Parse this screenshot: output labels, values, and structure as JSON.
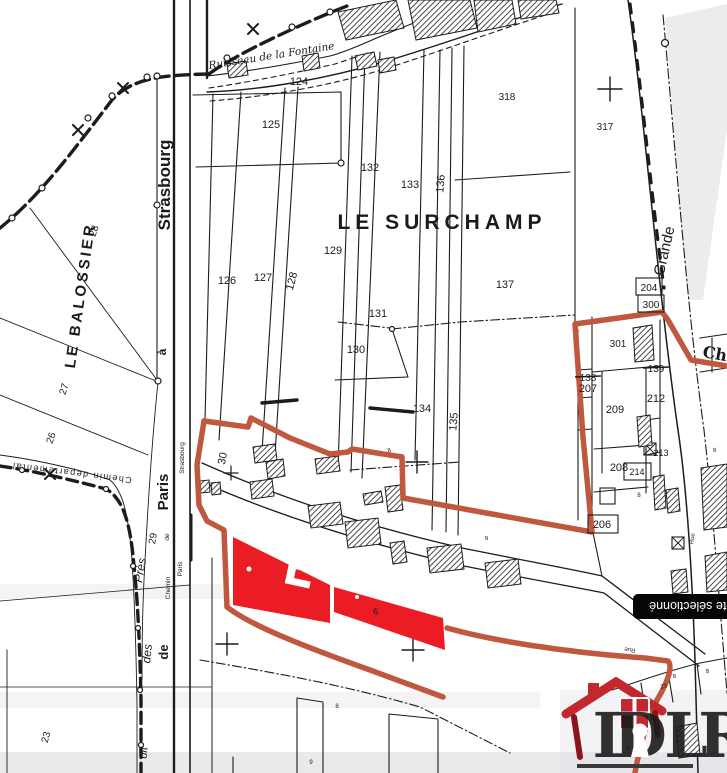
{
  "map": {
    "area_labels": [
      {
        "t": "LE SURCHAMP",
        "x": 442,
        "y": 229,
        "fs": 21,
        "b": 1,
        "ls": 5,
        "name": "area-label-le-surchamp"
      },
      {
        "t": "LE BALOSSIER",
        "x": 85,
        "y": 296,
        "r": -82,
        "fs": 15,
        "b": 1,
        "ls": 3,
        "name": "area-label-le-balossier"
      }
    ],
    "street_labels": [
      {
        "t": "Strasbourg",
        "x": 170,
        "y": 185,
        "r": -90,
        "fs": 17,
        "b": 1
      },
      {
        "t": "à",
        "x": 166,
        "y": 352,
        "r": -90,
        "fs": 12,
        "b": 1
      },
      {
        "t": "Paris",
        "x": 168,
        "y": 492,
        "r": -90,
        "fs": 15,
        "b": 1
      },
      {
        "t": "de",
        "x": 168,
        "y": 652,
        "r": -90,
        "fs": 13,
        "b": 1
      },
      {
        "t": "Grande",
        "x": 669,
        "y": 252,
        "r": -77,
        "fs": 15
      },
      {
        "t": "Ch",
        "x": 714,
        "y": 359,
        "r": 10,
        "fs": 16,
        "b": 1,
        "serif": 1
      },
      {
        "t": "Rue",
        "x": 694,
        "y": 539,
        "r": -80,
        "fs": 6
      },
      {
        "t": "Rue",
        "x": 630,
        "y": 648,
        "r": 186,
        "fs": 6
      },
      {
        "t": "Strasbourg",
        "x": 184,
        "y": 458,
        "r": -90,
        "fs": 6.5
      },
      {
        "t": "Paris",
        "x": 182,
        "y": 569,
        "r": -90,
        "fs": 6.5
      },
      {
        "t": "Chemin",
        "x": 170,
        "y": 588,
        "r": -90,
        "fs": 6.5
      },
      {
        "t": "de",
        "x": 169,
        "y": 537,
        "r": -90,
        "fs": 6.5
      },
      {
        "t": "Chemin departemental",
        "x": 72,
        "y": 470,
        "r": 187,
        "fs": 9,
        "ls": 1.5
      },
      {
        "t": "dit",
        "x": 147,
        "y": 753,
        "r": -85,
        "fs": 11,
        "i": 1
      },
      {
        "t": "des",
        "x": 151,
        "y": 654,
        "r": -85,
        "fs": 12,
        "i": 1
      },
      {
        "t": "Près",
        "x": 144,
        "y": 571,
        "r": -80,
        "fs": 12,
        "i": 1
      },
      {
        "t": "Ruisseau de la Fontaine",
        "x": 272,
        "y": 59,
        "r": -9,
        "fs": 10.5,
        "i": 1,
        "serif": 1
      }
    ],
    "parcel_numbers": [
      {
        "t": "124",
        "x": 299,
        "y": 85
      },
      {
        "t": "125",
        "x": 271,
        "y": 128
      },
      {
        "t": "318",
        "x": 507,
        "y": 100,
        "fs": 10
      },
      {
        "t": "317",
        "x": 605,
        "y": 130,
        "fs": 10
      },
      {
        "t": "132",
        "x": 370,
        "y": 171
      },
      {
        "t": "133",
        "x": 410,
        "y": 188
      },
      {
        "t": "136",
        "x": 444,
        "y": 184,
        "r": -85
      },
      {
        "t": "126",
        "x": 227,
        "y": 284
      },
      {
        "t": "127",
        "x": 263,
        "y": 281
      },
      {
        "t": "128",
        "x": 295,
        "y": 282,
        "r": -75
      },
      {
        "t": "129",
        "x": 333,
        "y": 254
      },
      {
        "t": "131",
        "x": 378,
        "y": 317
      },
      {
        "t": "130",
        "x": 356,
        "y": 353
      },
      {
        "t": "137",
        "x": 505,
        "y": 288
      },
      {
        "t": "134",
        "x": 422,
        "y": 412
      },
      {
        "t": "135",
        "x": 457,
        "y": 422,
        "r": -85
      },
      {
        "t": "30",
        "x": 226,
        "y": 459,
        "r": -80
      },
      {
        "t": "29",
        "x": 156,
        "y": 539,
        "r": -80,
        "fs": 10
      },
      {
        "t": "28",
        "x": 97,
        "y": 232,
        "r": -70,
        "fs": 10
      },
      {
        "t": "27",
        "x": 67,
        "y": 390,
        "r": -72,
        "fs": 10
      },
      {
        "t": "26",
        "x": 54,
        "y": 439,
        "r": -70,
        "fs": 10
      },
      {
        "t": "23",
        "x": 49,
        "y": 738,
        "r": -75,
        "fs": 10
      },
      {
        "t": "204",
        "x": 649,
        "y": 291,
        "fs": 10,
        "box": [
          636,
          278,
          26,
          17
        ]
      },
      {
        "t": "300",
        "x": 651,
        "y": 308,
        "fs": 10,
        "box": [
          638,
          295,
          26,
          17
        ]
      },
      {
        "t": "301",
        "x": 618,
        "y": 347,
        "fs": 10
      },
      {
        "t": "138",
        "x": 588,
        "y": 381,
        "strike": 1,
        "fs": 10
      },
      {
        "t": "207",
        "x": 588,
        "y": 392
      },
      {
        "t": "139",
        "x": 656,
        "y": 372,
        "strike": 1,
        "fs": 10
      },
      {
        "t": "209",
        "x": 615,
        "y": 413
      },
      {
        "t": "212",
        "x": 656,
        "y": 402
      },
      {
        "t": "213",
        "x": 661,
        "y": 456,
        "fs": 9
      },
      {
        "t": "208",
        "x": 619,
        "y": 471
      },
      {
        "t": "214",
        "x": 637,
        "y": 475,
        "fs": 9,
        "box": [
          624,
          463,
          27,
          17
        ]
      },
      {
        "t": "206",
        "x": 602,
        "y": 528,
        "box": [
          588,
          515,
          30,
          18
        ]
      }
    ],
    "micro_marks": [
      {
        "t": "8",
        "x": 390,
        "y": 452,
        "r": -20
      },
      {
        "t": "8",
        "x": 639,
        "y": 497
      },
      {
        "t": "8",
        "x": 715,
        "y": 452,
        "r": -10
      },
      {
        "t": "8",
        "x": 675,
        "y": 678,
        "r": -15
      },
      {
        "t": "8",
        "x": 708,
        "y": 673,
        "r": -15
      },
      {
        "t": "8",
        "x": 337,
        "y": 708
      },
      {
        "t": "9",
        "x": 311,
        "y": 764
      },
      {
        "t": "23",
        "x": 664,
        "y": 688,
        "r": -10
      },
      {
        "t": "8",
        "x": 628,
        "y": 751
      },
      {
        "t": "9",
        "x": 487,
        "y": 540,
        "r": -15
      }
    ]
  },
  "selection": {
    "outline_color": "#c0573f",
    "parcel_fill_color": "#ec1c24",
    "building_mark": "U"
  },
  "tooltip": {
    "text": "texte sélectionné",
    "bg": "#060606",
    "color": "#ffffff"
  },
  "logo": {
    "letters": "IDLR",
    "house_color": "#c2282e",
    "wall_color": "#8c151b",
    "letter_color": "#3c3c3e"
  }
}
